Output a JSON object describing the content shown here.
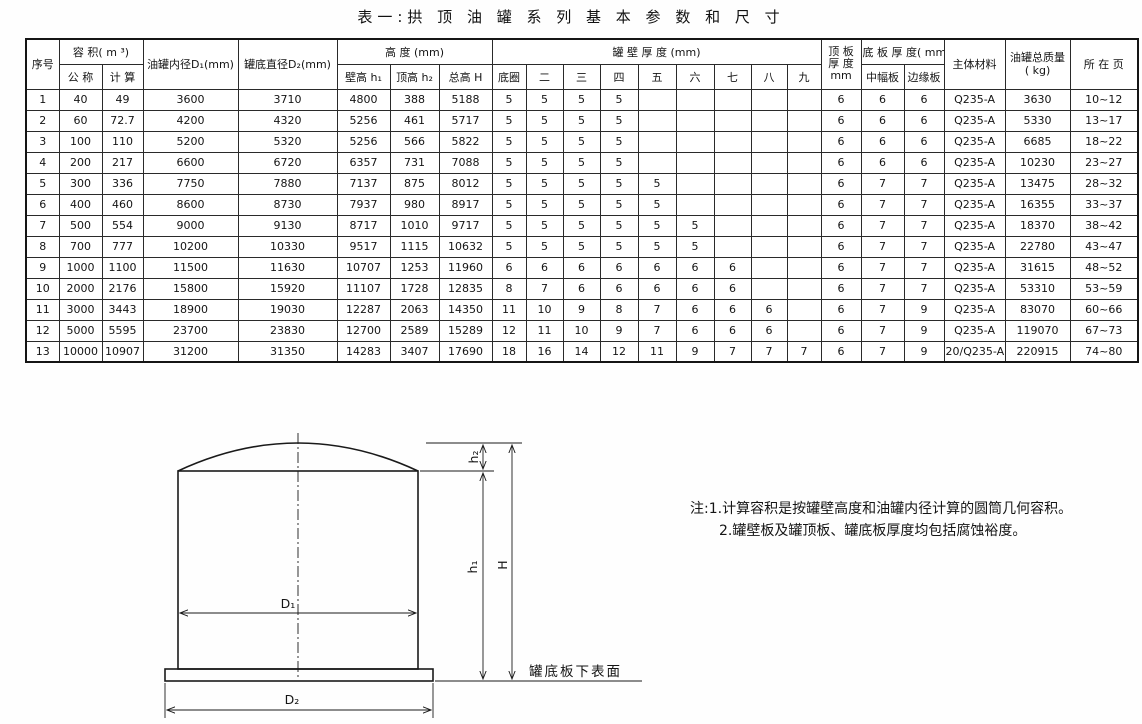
{
  "title": "表一:拱 顶 油 罐 系 列 基 本 参 数 和 尺 寸",
  "table": {
    "header": {
      "xuhao": "序号",
      "rongji": "容  积( m ³)",
      "gongcheng": "公 称",
      "jisuan": "计 算",
      "neijing": "油罐内径D₁(mm)",
      "dijing": "罐底直径D₂(mm)",
      "gaodu": "高  度  (mm)",
      "bigao": "壁高 h₁",
      "dinggao": "顶高 h₂",
      "zonggao": "总高 H",
      "guanbi": "罐  壁  厚  度 (mm)",
      "diquan": "底圈",
      "er": "二",
      "san": "三",
      "si": "四",
      "wu": "五",
      "liu": "六",
      "qi": "七",
      "ba": "八",
      "jiu": "九",
      "dingban1": "顶 板",
      "dingban2": "厚 度",
      "dingban3": "mm",
      "diban": "底 板 厚 度( mm",
      "zhongfu": "中幅板",
      "bianyuan": "边缘板",
      "zhuti": "主体材料",
      "zhiliang1": "油罐总质量",
      "zhiliang2": "( kg)",
      "suozaiye": "所 在 页"
    },
    "rows": [
      [
        "1",
        "40",
        "49",
        "3600",
        "3710",
        "4800",
        "388",
        "5188",
        "5",
        "5",
        "5",
        "5",
        "",
        "",
        "",
        "",
        "",
        "6",
        "6",
        "6",
        "Q235-A",
        "3630",
        "10~12"
      ],
      [
        "2",
        "60",
        "72.7",
        "4200",
        "4320",
        "5256",
        "461",
        "5717",
        "5",
        "5",
        "5",
        "5",
        "",
        "",
        "",
        "",
        "",
        "6",
        "6",
        "6",
        "Q235-A",
        "5330",
        "13~17"
      ],
      [
        "3",
        "100",
        "110",
        "5200",
        "5320",
        "5256",
        "566",
        "5822",
        "5",
        "5",
        "5",
        "5",
        "",
        "",
        "",
        "",
        "",
        "6",
        "6",
        "6",
        "Q235-A",
        "6685",
        "18~22"
      ],
      [
        "4",
        "200",
        "217",
        "6600",
        "6720",
        "6357",
        "731",
        "7088",
        "5",
        "5",
        "5",
        "5",
        "",
        "",
        "",
        "",
        "",
        "6",
        "6",
        "6",
        "Q235-A",
        "10230",
        "23~27"
      ],
      [
        "5",
        "300",
        "336",
        "7750",
        "7880",
        "7137",
        "875",
        "8012",
        "5",
        "5",
        "5",
        "5",
        "5",
        "",
        "",
        "",
        "",
        "6",
        "7",
        "7",
        "Q235-A",
        "13475",
        "28~32"
      ],
      [
        "6",
        "400",
        "460",
        "8600",
        "8730",
        "7937",
        "980",
        "8917",
        "5",
        "5",
        "5",
        "5",
        "5",
        "",
        "",
        "",
        "",
        "6",
        "7",
        "7",
        "Q235-A",
        "16355",
        "33~37"
      ],
      [
        "7",
        "500",
        "554",
        "9000",
        "9130",
        "8717",
        "1010",
        "9717",
        "5",
        "5",
        "5",
        "5",
        "5",
        "5",
        "",
        "",
        "",
        "6",
        "7",
        "7",
        "Q235-A",
        "18370",
        "38~42"
      ],
      [
        "8",
        "700",
        "777",
        "10200",
        "10330",
        "9517",
        "1115",
        "10632",
        "5",
        "5",
        "5",
        "5",
        "5",
        "5",
        "",
        "",
        "",
        "6",
        "7",
        "7",
        "Q235-A",
        "22780",
        "43~47"
      ],
      [
        "9",
        "1000",
        "1100",
        "11500",
        "11630",
        "10707",
        "1253",
        "11960",
        "6",
        "6",
        "6",
        "6",
        "6",
        "6",
        "6",
        "",
        "",
        "6",
        "7",
        "7",
        "Q235-A",
        "31615",
        "48~52"
      ],
      [
        "10",
        "2000",
        "2176",
        "15800",
        "15920",
        "11107",
        "1728",
        "12835",
        "8",
        "7",
        "6",
        "6",
        "6",
        "6",
        "6",
        "",
        "",
        "6",
        "7",
        "7",
        "Q235-A",
        "53310",
        "53~59"
      ],
      [
        "11",
        "3000",
        "3443",
        "18900",
        "19030",
        "12287",
        "2063",
        "14350",
        "11",
        "10",
        "9",
        "8",
        "7",
        "6",
        "6",
        "6",
        "",
        "6",
        "7",
        "9",
        "Q235-A",
        "83070",
        "60~66"
      ],
      [
        "12",
        "5000",
        "5595",
        "23700",
        "23830",
        "12700",
        "2589",
        "15289",
        "12",
        "11",
        "10",
        "9",
        "7",
        "6",
        "6",
        "6",
        "",
        "6",
        "7",
        "9",
        "Q235-A",
        "119070",
        "67~73"
      ],
      [
        "13",
        "10000",
        "10907",
        "31200",
        "31350",
        "14283",
        "3407",
        "17690",
        "18",
        "16",
        "14",
        "12",
        "11",
        "9",
        "7",
        "7",
        "7",
        "6",
        "7",
        "9",
        "20/Q235-A",
        "220915",
        "74~80"
      ]
    ]
  },
  "drawing": {
    "labels": {
      "d1": "D₁",
      "d2": "D₂",
      "h1": "h₁",
      "h2": "h₂",
      "big_h": "H",
      "bottom_surface": "罐底板下表面"
    }
  },
  "notes": {
    "line1": "注:1.计算容积是按罐壁高度和油罐内径计算的圆筒几何容积。",
    "line2": "2.罐壁板及罐顶板、罐底板厚度均包括腐蚀裕度。"
  },
  "colors": {
    "ink": "#1a1a1a",
    "paper": "#ffffff"
  }
}
